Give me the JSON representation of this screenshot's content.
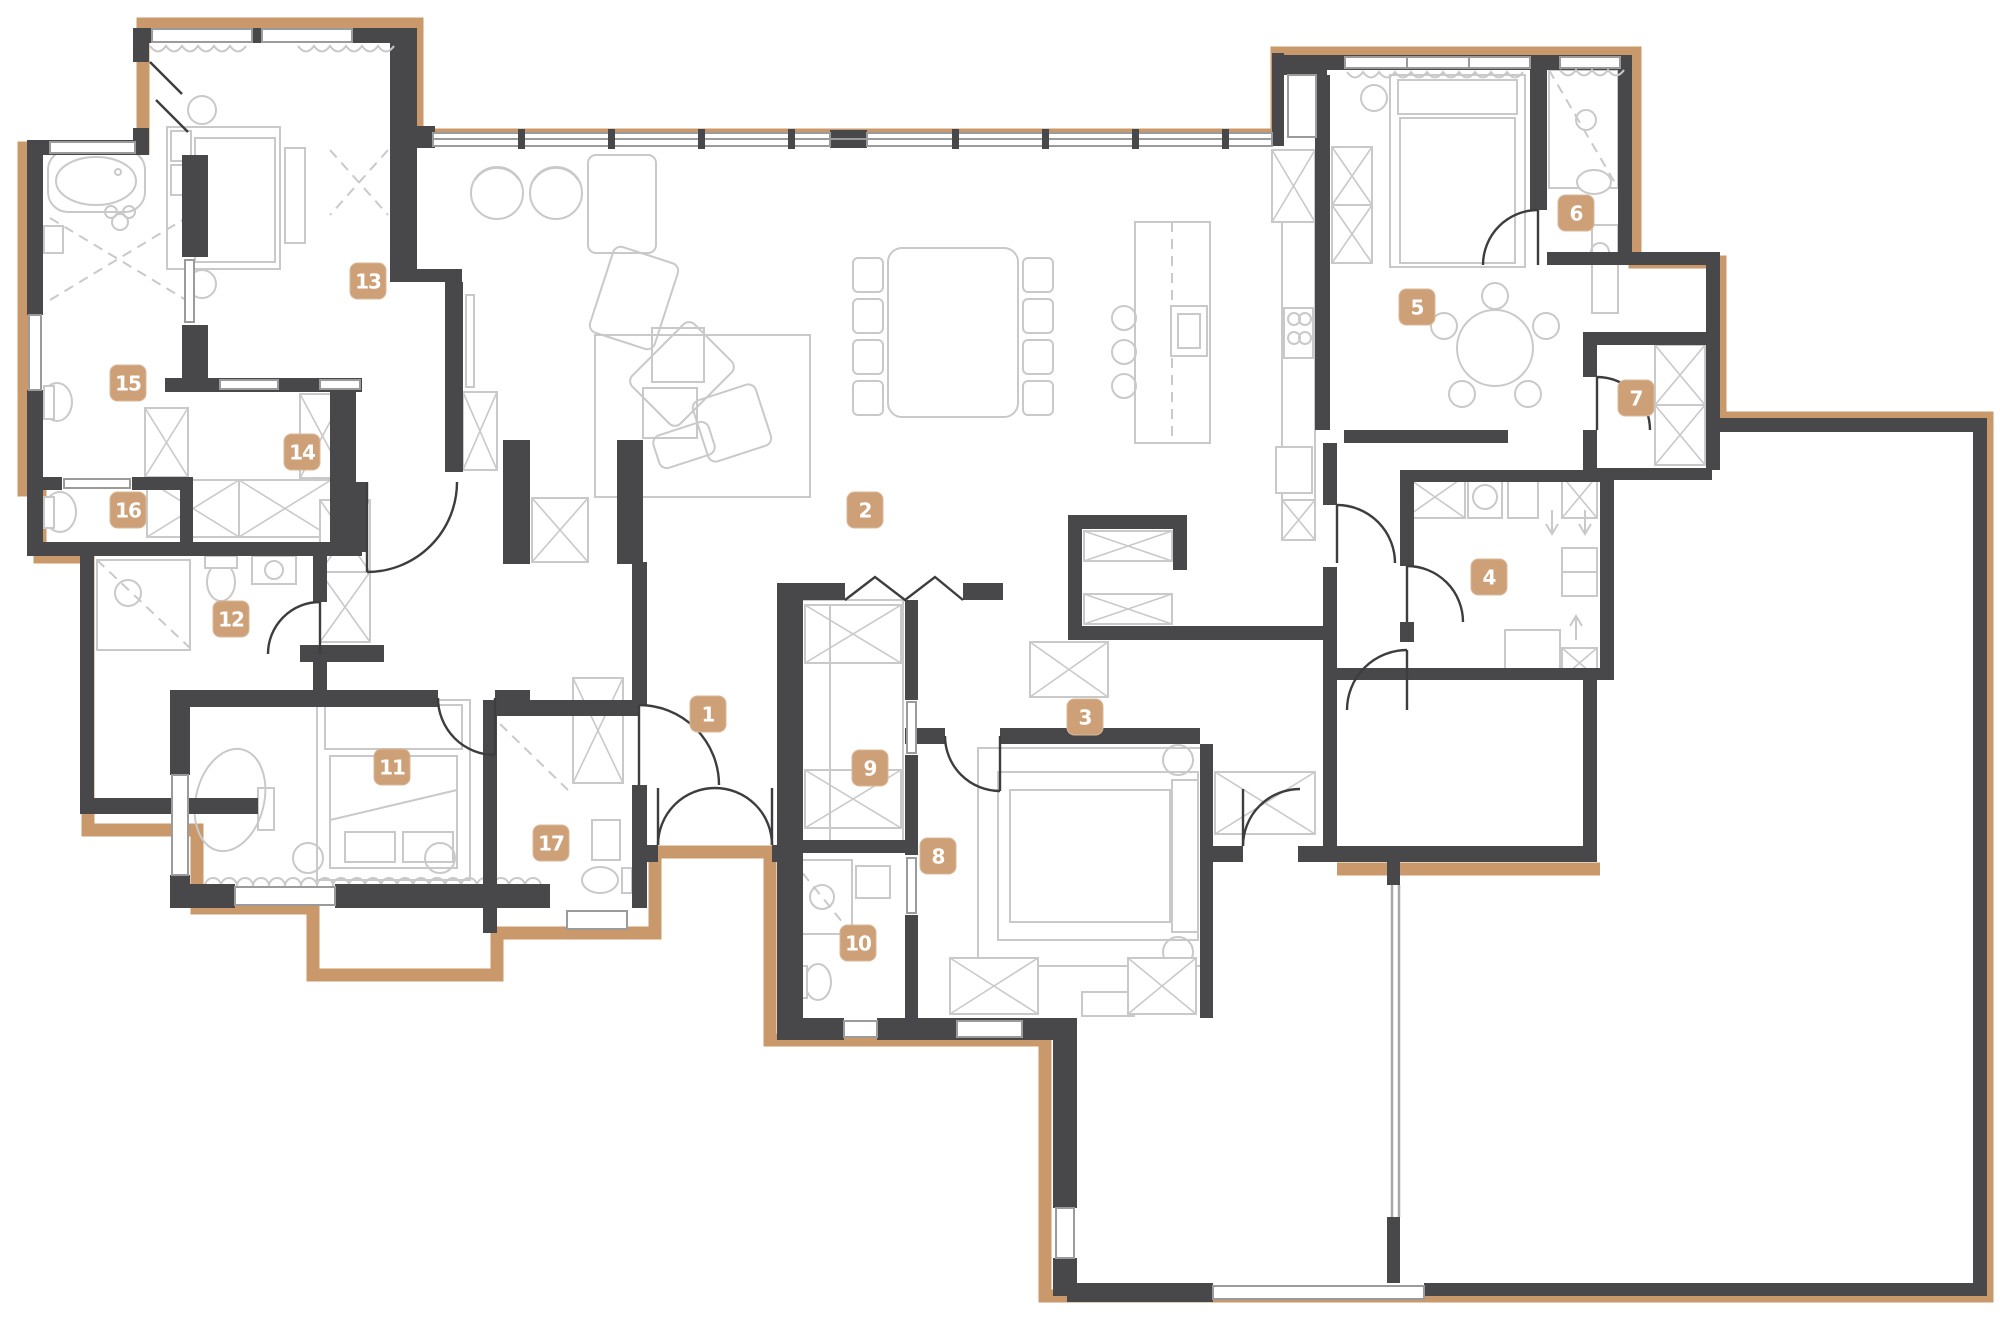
{
  "plan": {
    "type": "apartment-floor-plan",
    "width": 2000,
    "height": 1326,
    "rooms": [
      {
        "number": "1",
        "x": 708,
        "y": 714
      },
      {
        "number": "2",
        "x": 865,
        "y": 510
      },
      {
        "number": "3",
        "x": 1085,
        "y": 717
      },
      {
        "number": "4",
        "x": 1489,
        "y": 577
      },
      {
        "number": "5",
        "x": 1417,
        "y": 307
      },
      {
        "number": "6",
        "x": 1576,
        "y": 213
      },
      {
        "number": "7",
        "x": 1636,
        "y": 398
      },
      {
        "number": "8",
        "x": 938,
        "y": 856
      },
      {
        "number": "9",
        "x": 870,
        "y": 768
      },
      {
        "number": "10",
        "x": 858,
        "y": 943
      },
      {
        "number": "11",
        "x": 392,
        "y": 767
      },
      {
        "number": "12",
        "x": 231,
        "y": 619
      },
      {
        "number": "13",
        "x": 368,
        "y": 281
      },
      {
        "number": "14",
        "x": 302,
        "y": 452
      },
      {
        "number": "15",
        "x": 128,
        "y": 383
      },
      {
        "number": "16",
        "x": 128,
        "y": 510
      },
      {
        "number": "17",
        "x": 551,
        "y": 843
      }
    ]
  },
  "colors": {
    "background": "#ffffff",
    "exterior_outline": "#C9996B",
    "wall": "#48484A",
    "furniture_line": "#C9C9C9",
    "badge": "#CDA077",
    "badge_text": "#FFFFFF"
  }
}
